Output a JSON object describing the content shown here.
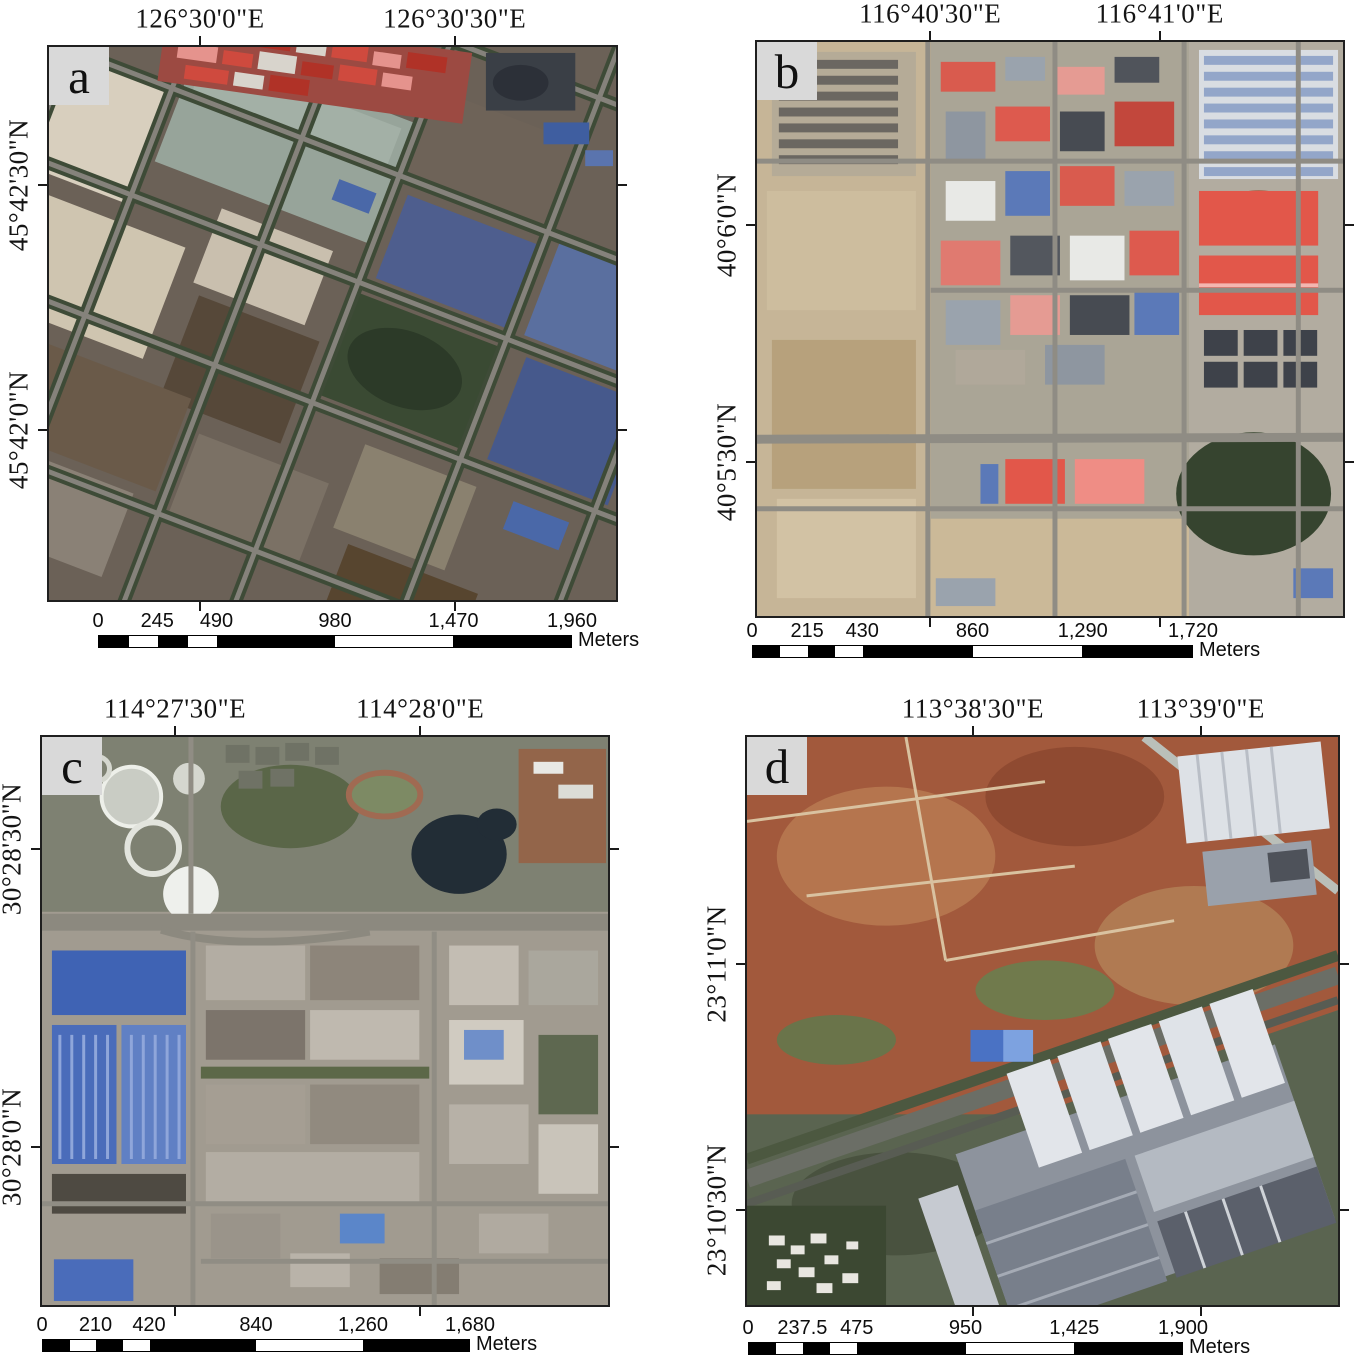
{
  "palette": {
    "frame_border": "#1f1f1f",
    "panel_letter_bg": "#d9d9d9",
    "text": "#141414",
    "scalebar_black": "#000000",
    "scalebar_white": "#ffffff"
  },
  "scalebar_segments": [
    {
      "from": 0,
      "to": 0.0625,
      "fill": "#000000"
    },
    {
      "from": 0.0625,
      "to": 0.125,
      "fill": "#ffffff"
    },
    {
      "from": 0.125,
      "to": 0.1875,
      "fill": "#000000"
    },
    {
      "from": 0.1875,
      "to": 0.25,
      "fill": "#ffffff"
    },
    {
      "from": 0.25,
      "to": 0.5,
      "fill": "#000000"
    },
    {
      "from": 0.5,
      "to": 0.75,
      "fill": "#ffffff"
    },
    {
      "from": 0.75,
      "to": 1,
      "fill": "#000000"
    }
  ],
  "panels": [
    {
      "id": "a",
      "letter": "a",
      "lon_labels": [
        "126°30'0\"E",
        "126°30'30\"E"
      ],
      "lat_labels": [
        "45°42'30\"N",
        "45°42'0\"N"
      ],
      "lon_fracs": [
        0.268,
        0.714
      ],
      "lat_fracs": [
        0.251,
        0.691
      ],
      "scalebar": {
        "tick_labels": [
          "0",
          "245",
          "490",
          "980",
          "1,470",
          "1,960"
        ],
        "tick_fracs": [
          0,
          0.125,
          0.25,
          0.5,
          0.75,
          1
        ],
        "unit": "Meters"
      }
    },
    {
      "id": "b",
      "letter": "b",
      "lon_labels": [
        "116°40'30\"E",
        "116°41'0\"E"
      ],
      "lat_labels": [
        "40°6'0\"N",
        "40°5'30\"N"
      ],
      "lon_fracs": [
        0.297,
        0.686
      ],
      "lat_fracs": [
        0.32,
        0.73
      ],
      "scalebar": {
        "tick_labels": [
          "0",
          "215",
          "430",
          "860",
          "1,290",
          "1,720"
        ],
        "tick_fracs": [
          0,
          0.125,
          0.25,
          0.5,
          0.75,
          1
        ],
        "unit": "Meters"
      }
    },
    {
      "id": "c",
      "letter": "c",
      "lon_labels": [
        "114°27'30\"E",
        "114°28'0\"E"
      ],
      "lat_labels": [
        "30°28'30\"N",
        "30°28'0\"N"
      ],
      "lon_fracs": [
        0.237,
        0.667
      ],
      "lat_fracs": [
        0.2,
        0.72
      ],
      "scalebar": {
        "tick_labels": [
          "0",
          "210",
          "420",
          "840",
          "1,260",
          "1,680"
        ],
        "tick_fracs": [
          0,
          0.125,
          0.25,
          0.5,
          0.75,
          1
        ],
        "unit": "Meters"
      }
    },
    {
      "id": "d",
      "letter": "d",
      "lon_labels": [
        "113°38'30\"E",
        "113°39'0\"E"
      ],
      "lat_labels": [
        "23°11'0\"N",
        "23°10'30\"N"
      ],
      "lon_fracs": [
        0.383,
        0.766
      ],
      "lat_fracs": [
        0.4,
        0.83
      ],
      "scalebar": {
        "tick_labels": [
          "0",
          "237.5",
          "475",
          "950",
          "1,425",
          "1,900"
        ],
        "tick_fracs": [
          0,
          0.125,
          0.25,
          0.5,
          0.75,
          1
        ],
        "unit": "Meters"
      }
    }
  ]
}
